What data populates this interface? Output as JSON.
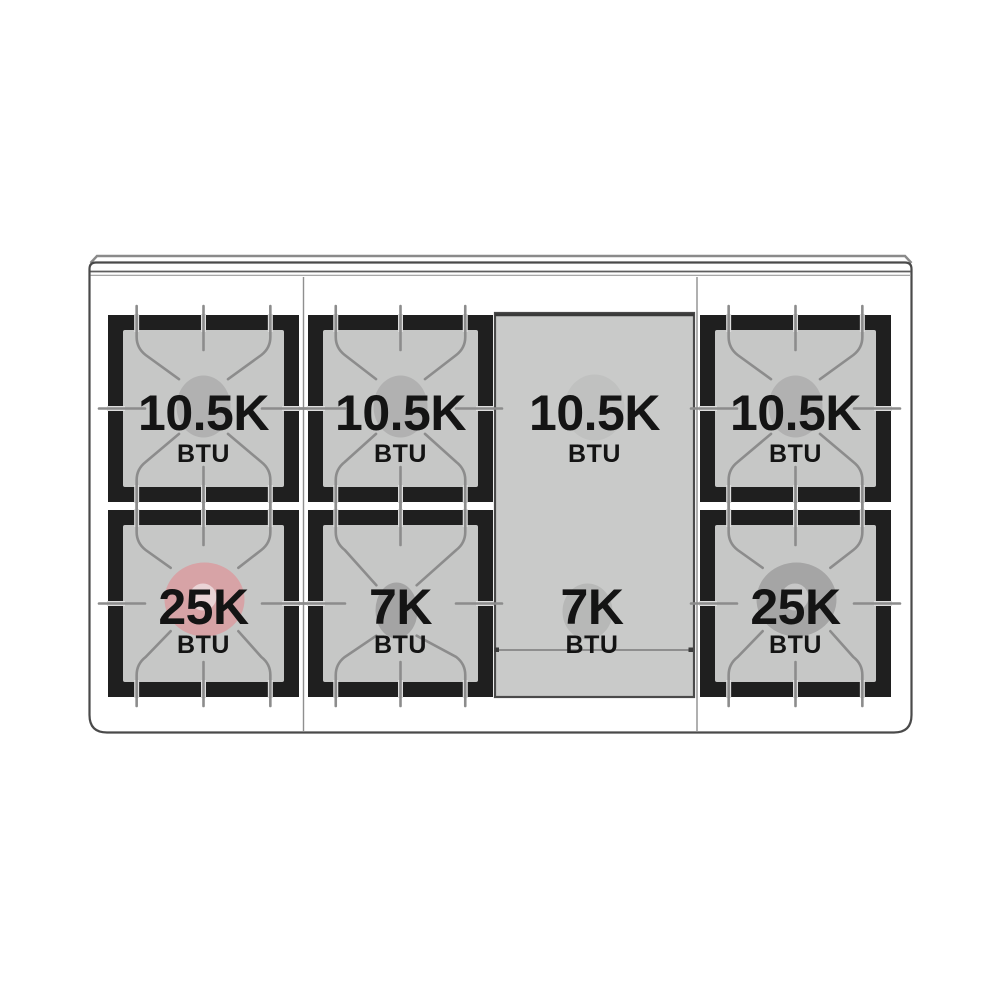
{
  "diagram": {
    "kind": "range-cooktop-burner-btu-layout",
    "unit_text": "BTU",
    "colors": {
      "frame_black": "#1f1f1f",
      "grate_surface": "#c6c7c6",
      "griddle_surface": "#c9cac9",
      "body_outline": "#4a4a4a",
      "grate_line": "#8c8c8c",
      "line_casing": "#dedede",
      "trim_dark": "#5f5f5f",
      "trim_light": "#9a9a9a",
      "divider": "#8f8f8f",
      "rear_ledge": "#8a8a8a",
      "griddle_inner_line": "#7a7a7a",
      "text": "#141414",
      "burner_gray": "#b1b1b1",
      "burner_small": "#a4a4a4",
      "burner_griddle": "#c0c1c0",
      "burner_griddle_front": "#b7b8b7",
      "dual_outer_pink": "#d7a3a6",
      "dual_inner_pink": "#ead4d6",
      "dual_outer_gray": "#a5a5a5",
      "dual_inner_gray": "#c7c7c7"
    },
    "burners": [
      {
        "name": "left-rear",
        "col": 0,
        "row": "rear",
        "label": "10.5K",
        "unit": "BTU",
        "style": "single_rear",
        "color": "burner_gray"
      },
      {
        "name": "center-left-rear",
        "col": 1,
        "row": "rear",
        "label": "10.5K",
        "unit": "BTU",
        "style": "single_rear",
        "color": "burner_gray"
      },
      {
        "name": "griddle-rear",
        "col": 2,
        "row": "rear",
        "label": "10.5K",
        "unit": "BTU",
        "style": "griddle_rear",
        "color": "burner_griddle"
      },
      {
        "name": "right-rear",
        "col": 3,
        "row": "rear",
        "label": "10.5K",
        "unit": "BTU",
        "style": "single_rear",
        "color": "burner_gray"
      },
      {
        "name": "left-front",
        "col": 0,
        "row": "front",
        "label": "25K",
        "unit": "BTU",
        "style": "dual_front",
        "color": "dual_outer_pink",
        "inner_color": "dual_inner_pink"
      },
      {
        "name": "center-left-front",
        "col": 1,
        "row": "front",
        "label": "7K",
        "unit": "BTU",
        "style": "small_front",
        "color": "burner_small"
      },
      {
        "name": "griddle-front",
        "col": 2,
        "row": "front",
        "label": "7K",
        "unit": "BTU",
        "style": "griddle_front",
        "color": "burner_griddle_front"
      },
      {
        "name": "right-front",
        "col": 3,
        "row": "front",
        "label": "25K",
        "unit": "BTU",
        "style": "dual_front",
        "color": "dual_outer_gray",
        "inner_color": "dual_inner_gray"
      }
    ]
  }
}
